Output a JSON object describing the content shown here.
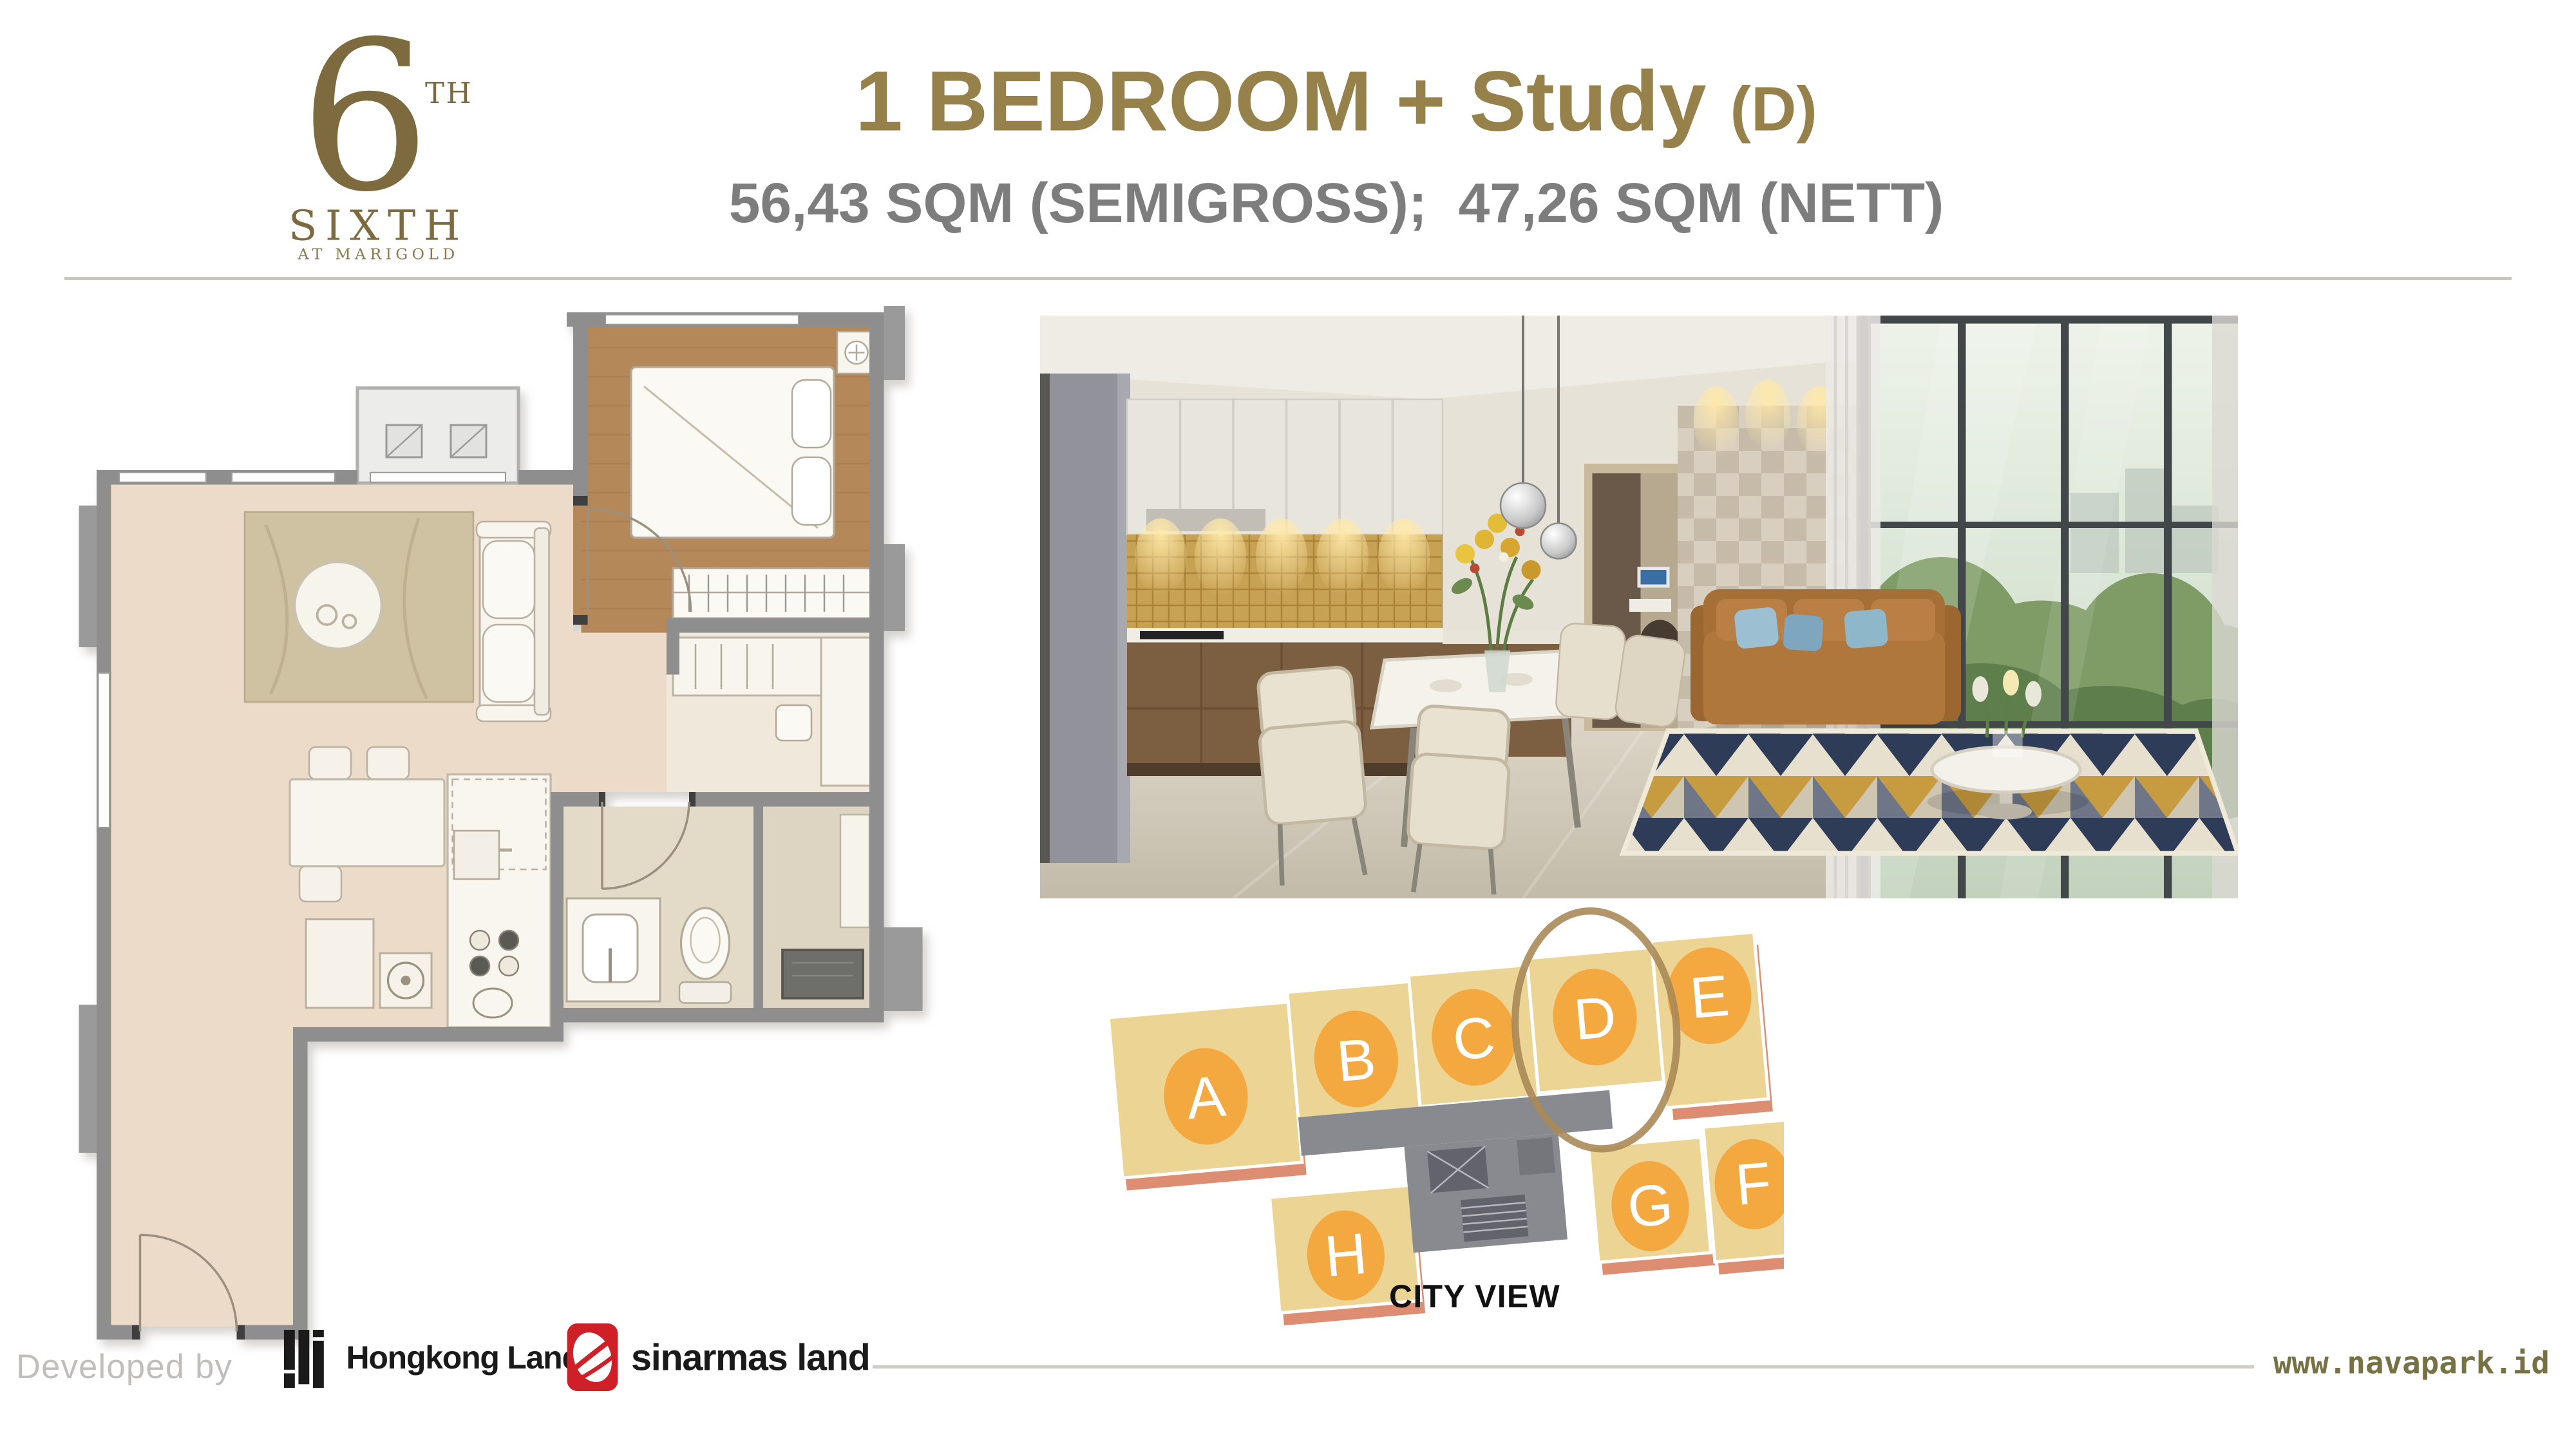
{
  "slide": {
    "brand": {
      "numeral": "6",
      "ordinal": "TH",
      "name": "SIXTH",
      "tagline": "AT MARIGOLD"
    },
    "title": "1 BEDROOM + Study",
    "title_unit": "(D)",
    "subtitle": "56,43 SQM (SEMIGROSS);  47,26 SQM (NETT)"
  },
  "key_plan": {
    "caption": "CITY VIEW",
    "highlighted_unit": "D",
    "units": [
      "A",
      "B",
      "C",
      "D",
      "E",
      "F",
      "G",
      "H"
    ]
  },
  "footer": {
    "developed_by": "Developed by",
    "developer_1": "Hongkong Land",
    "developer_2": "sinarmas land",
    "website": "www.navapark.id"
  },
  "palette": {
    "title_gold": "#97814A",
    "subtitle_gray": "#7D7D7D",
    "unit_marker_orange": "#F4A840",
    "keyplan_tan": "#ECD494",
    "keyplan_core_gray": "#898990",
    "keyplan_shadow_salmon": "#DD8E72",
    "highlight_ring_brown": "#AA8A58",
    "floorplan_wall_gray": "#8E8E8E",
    "floorplan_wood_brown": "#B5885A",
    "floorplan_floor_beige": "#ECDBC9",
    "sinarmas_red": "#CF2027",
    "website_olive": "#767243"
  }
}
